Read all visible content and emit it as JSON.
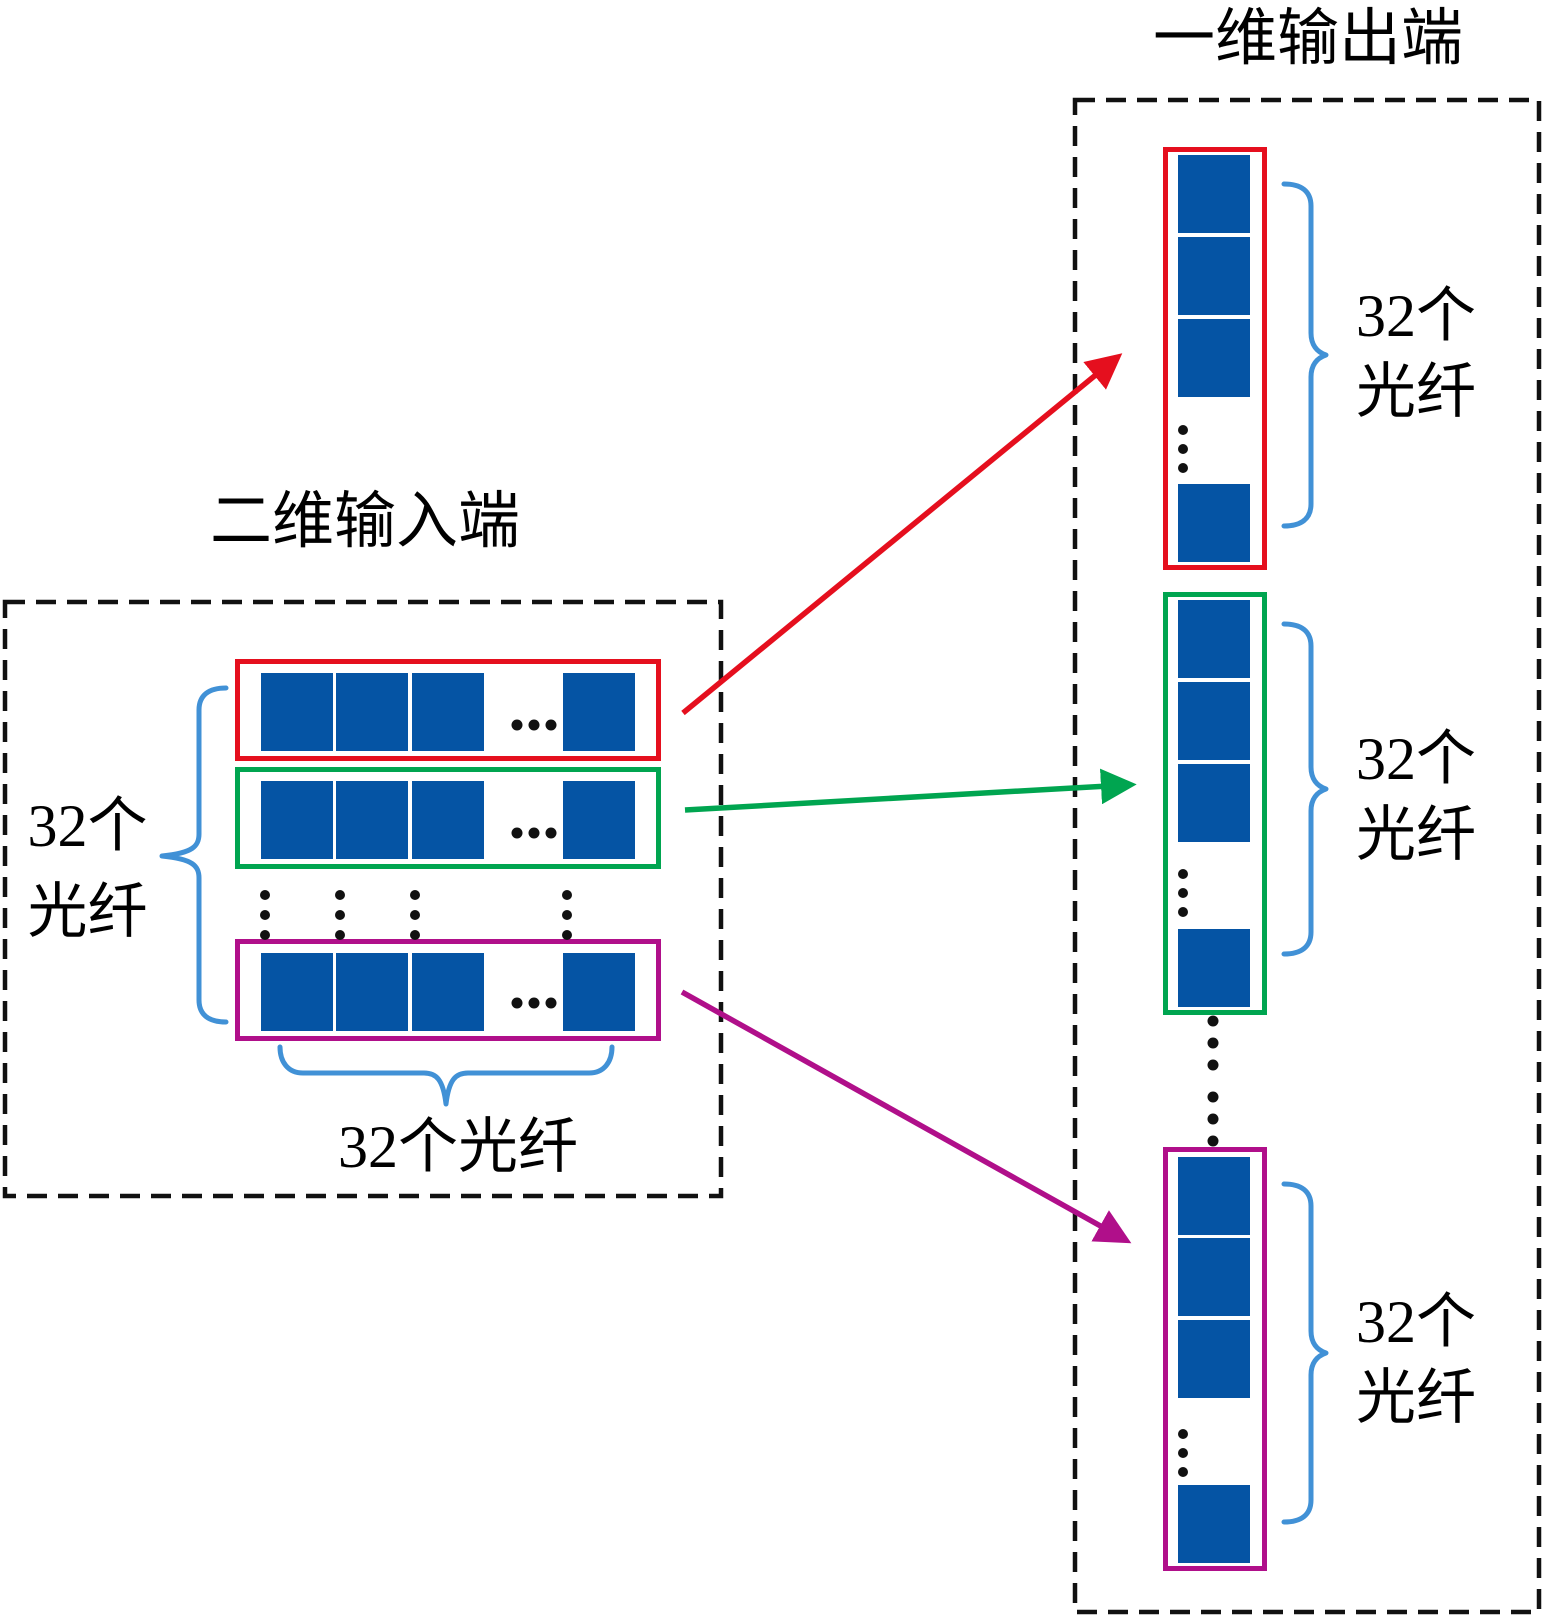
{
  "figure": {
    "input_panel": {
      "title": "二维输入端",
      "side_label": {
        "line1": "32个",
        "line2": "光纤"
      },
      "bottom_label": "32个光纤",
      "rows": [
        {
          "name": "input-row-1",
          "color_key": "outline_red"
        },
        {
          "name": "input-row-2",
          "color_key": "outline_green"
        },
        {
          "name": "input-row-last",
          "color_key": "outline_magenta"
        }
      ]
    },
    "output_panel": {
      "title": "一维输出端",
      "strips": [
        {
          "name": "output-strip-1",
          "color_key": "outline_red",
          "label": {
            "line1": "32个",
            "line2": "光纤"
          }
        },
        {
          "name": "output-strip-2",
          "color_key": "outline_green",
          "label": {
            "line1": "32个",
            "line2": "光纤"
          }
        },
        {
          "name": "output-strip-last",
          "color_key": "outline_magenta",
          "label": {
            "line1": "32个",
            "line2": "光纤"
          }
        }
      ]
    },
    "colors": {
      "fiber_blue": "#0554a4",
      "outline_red": "#e50f1e",
      "outline_green": "#00a550",
      "outline_magenta": "#b00f8a",
      "brace_blue": "#4191d6",
      "line_black": "#111111"
    }
  }
}
